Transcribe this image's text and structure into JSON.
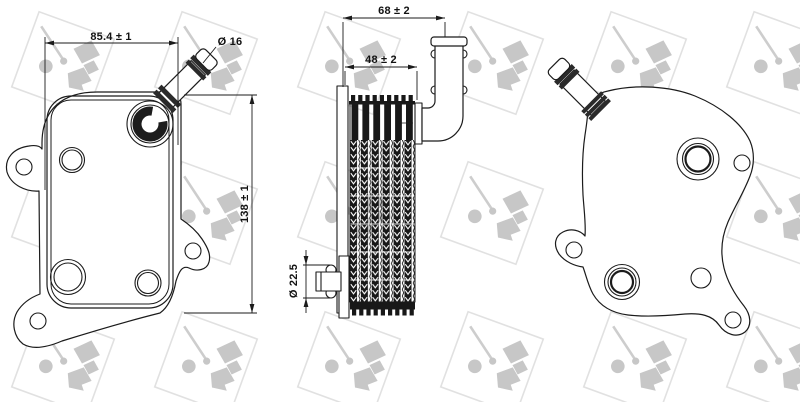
{
  "drawing": {
    "kind": "technical drawing, three orthographic views of an engine oil cooler",
    "watermark_brand": "NRF"
  },
  "dims": {
    "front_width": "85.4 ± 1",
    "front_height": "138 ± 1",
    "pipe_od": "Ø 16",
    "side_overall_width": "68 ± 2",
    "side_core_width": "48 ± 2",
    "port_od": "Ø 22.5"
  },
  "colors": {
    "background": "#ffffff",
    "line": "#1b1b1b",
    "core_fill": "#181818",
    "dimension_text": "#111111",
    "watermark_glyph": "#c7c7c7",
    "watermark_border": "#e1e1e1"
  }
}
